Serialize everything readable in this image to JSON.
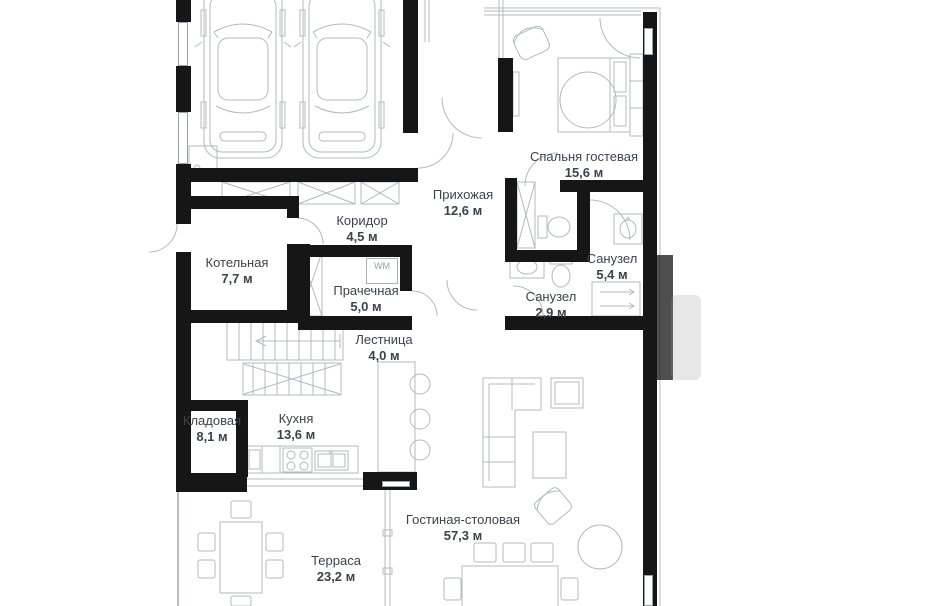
{
  "plan": {
    "type": "floor-plan",
    "language": "ru",
    "colors": {
      "wall": "#161616",
      "furniture_line": "#b4b9be",
      "text": "#3f4247"
    },
    "rooms": {
      "bedroom": {
        "name": "Спальня гостевая",
        "area": "15,6 м"
      },
      "hallway": {
        "name": "Прихожая",
        "area": "12,6 м"
      },
      "corridor": {
        "name": "Коридор",
        "area": "4,5 м"
      },
      "boiler": {
        "name": "Котельная",
        "area": "7,7 м"
      },
      "laundry": {
        "name": "Прачечная",
        "area": "5,0 м"
      },
      "bath_large": {
        "name": "Санузел",
        "area": "5,4 м"
      },
      "bath_small": {
        "name": "Санузел",
        "area": "2,9 м"
      },
      "stairs": {
        "name": "Лестница",
        "area": "4,0 м"
      },
      "storage": {
        "name": "Кладовая",
        "area": "8,1 м"
      },
      "kitchen": {
        "name": "Кухня",
        "area": "13,6 м"
      },
      "living": {
        "name": "Гостиная-столовая",
        "area": "57,3 м"
      },
      "terrace": {
        "name": "Терраса",
        "area": "23,2 м"
      }
    },
    "appliances": {
      "washer_label": "WM"
    }
  }
}
